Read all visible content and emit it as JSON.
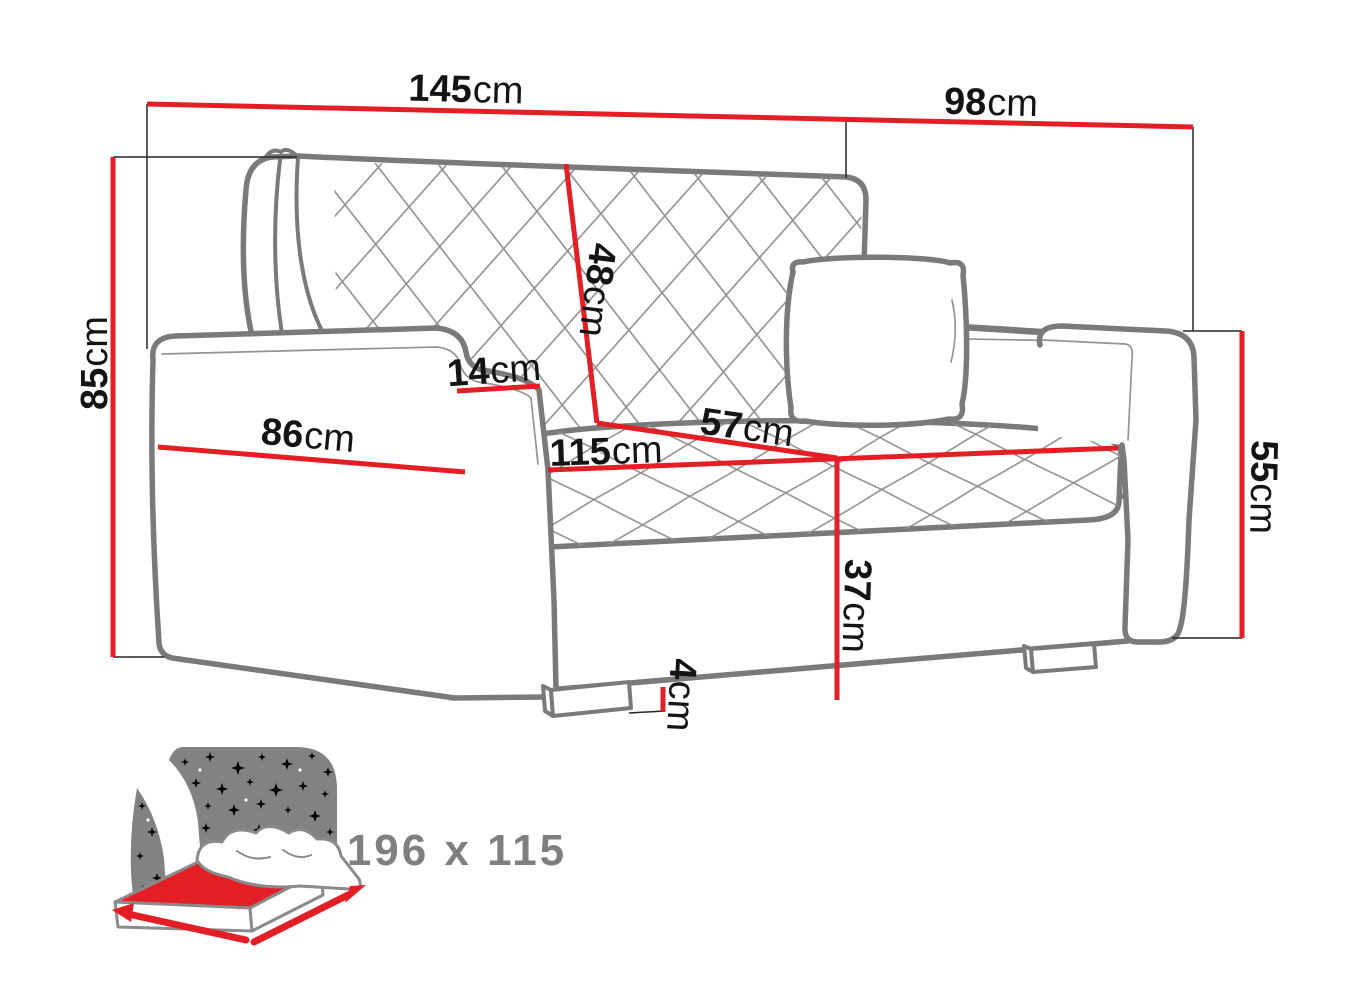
{
  "title": "Sofa bed dimension diagram",
  "dimensions": {
    "total_width": {
      "value": "145",
      "unit": "cm"
    },
    "total_depth": {
      "value": "98",
      "unit": "cm"
    },
    "total_height": {
      "value": "85",
      "unit": "cm"
    },
    "backrest_height": {
      "value": "48",
      "unit": "cm"
    },
    "armrest_top_width": {
      "value": "14",
      "unit": "cm"
    },
    "armrest_length": {
      "value": "86",
      "unit": "cm"
    },
    "seat_width": {
      "value": "115",
      "unit": "cm"
    },
    "seat_depth": {
      "value": "57",
      "unit": "cm"
    },
    "seat_height": {
      "value": "37",
      "unit": "cm"
    },
    "leg_height": {
      "value": "4",
      "unit": "cm"
    },
    "armrest_height": {
      "value": "55",
      "unit": "cm"
    }
  },
  "sleeping_area": {
    "size_label": "196 x 115"
  },
  "colors": {
    "dimension_red": "#e31e24",
    "sofa_outline_gray": "#7a7a7a",
    "icon_gray": "#828282",
    "size_text_gray": "#7f7f7f",
    "label_black": "#141414"
  }
}
